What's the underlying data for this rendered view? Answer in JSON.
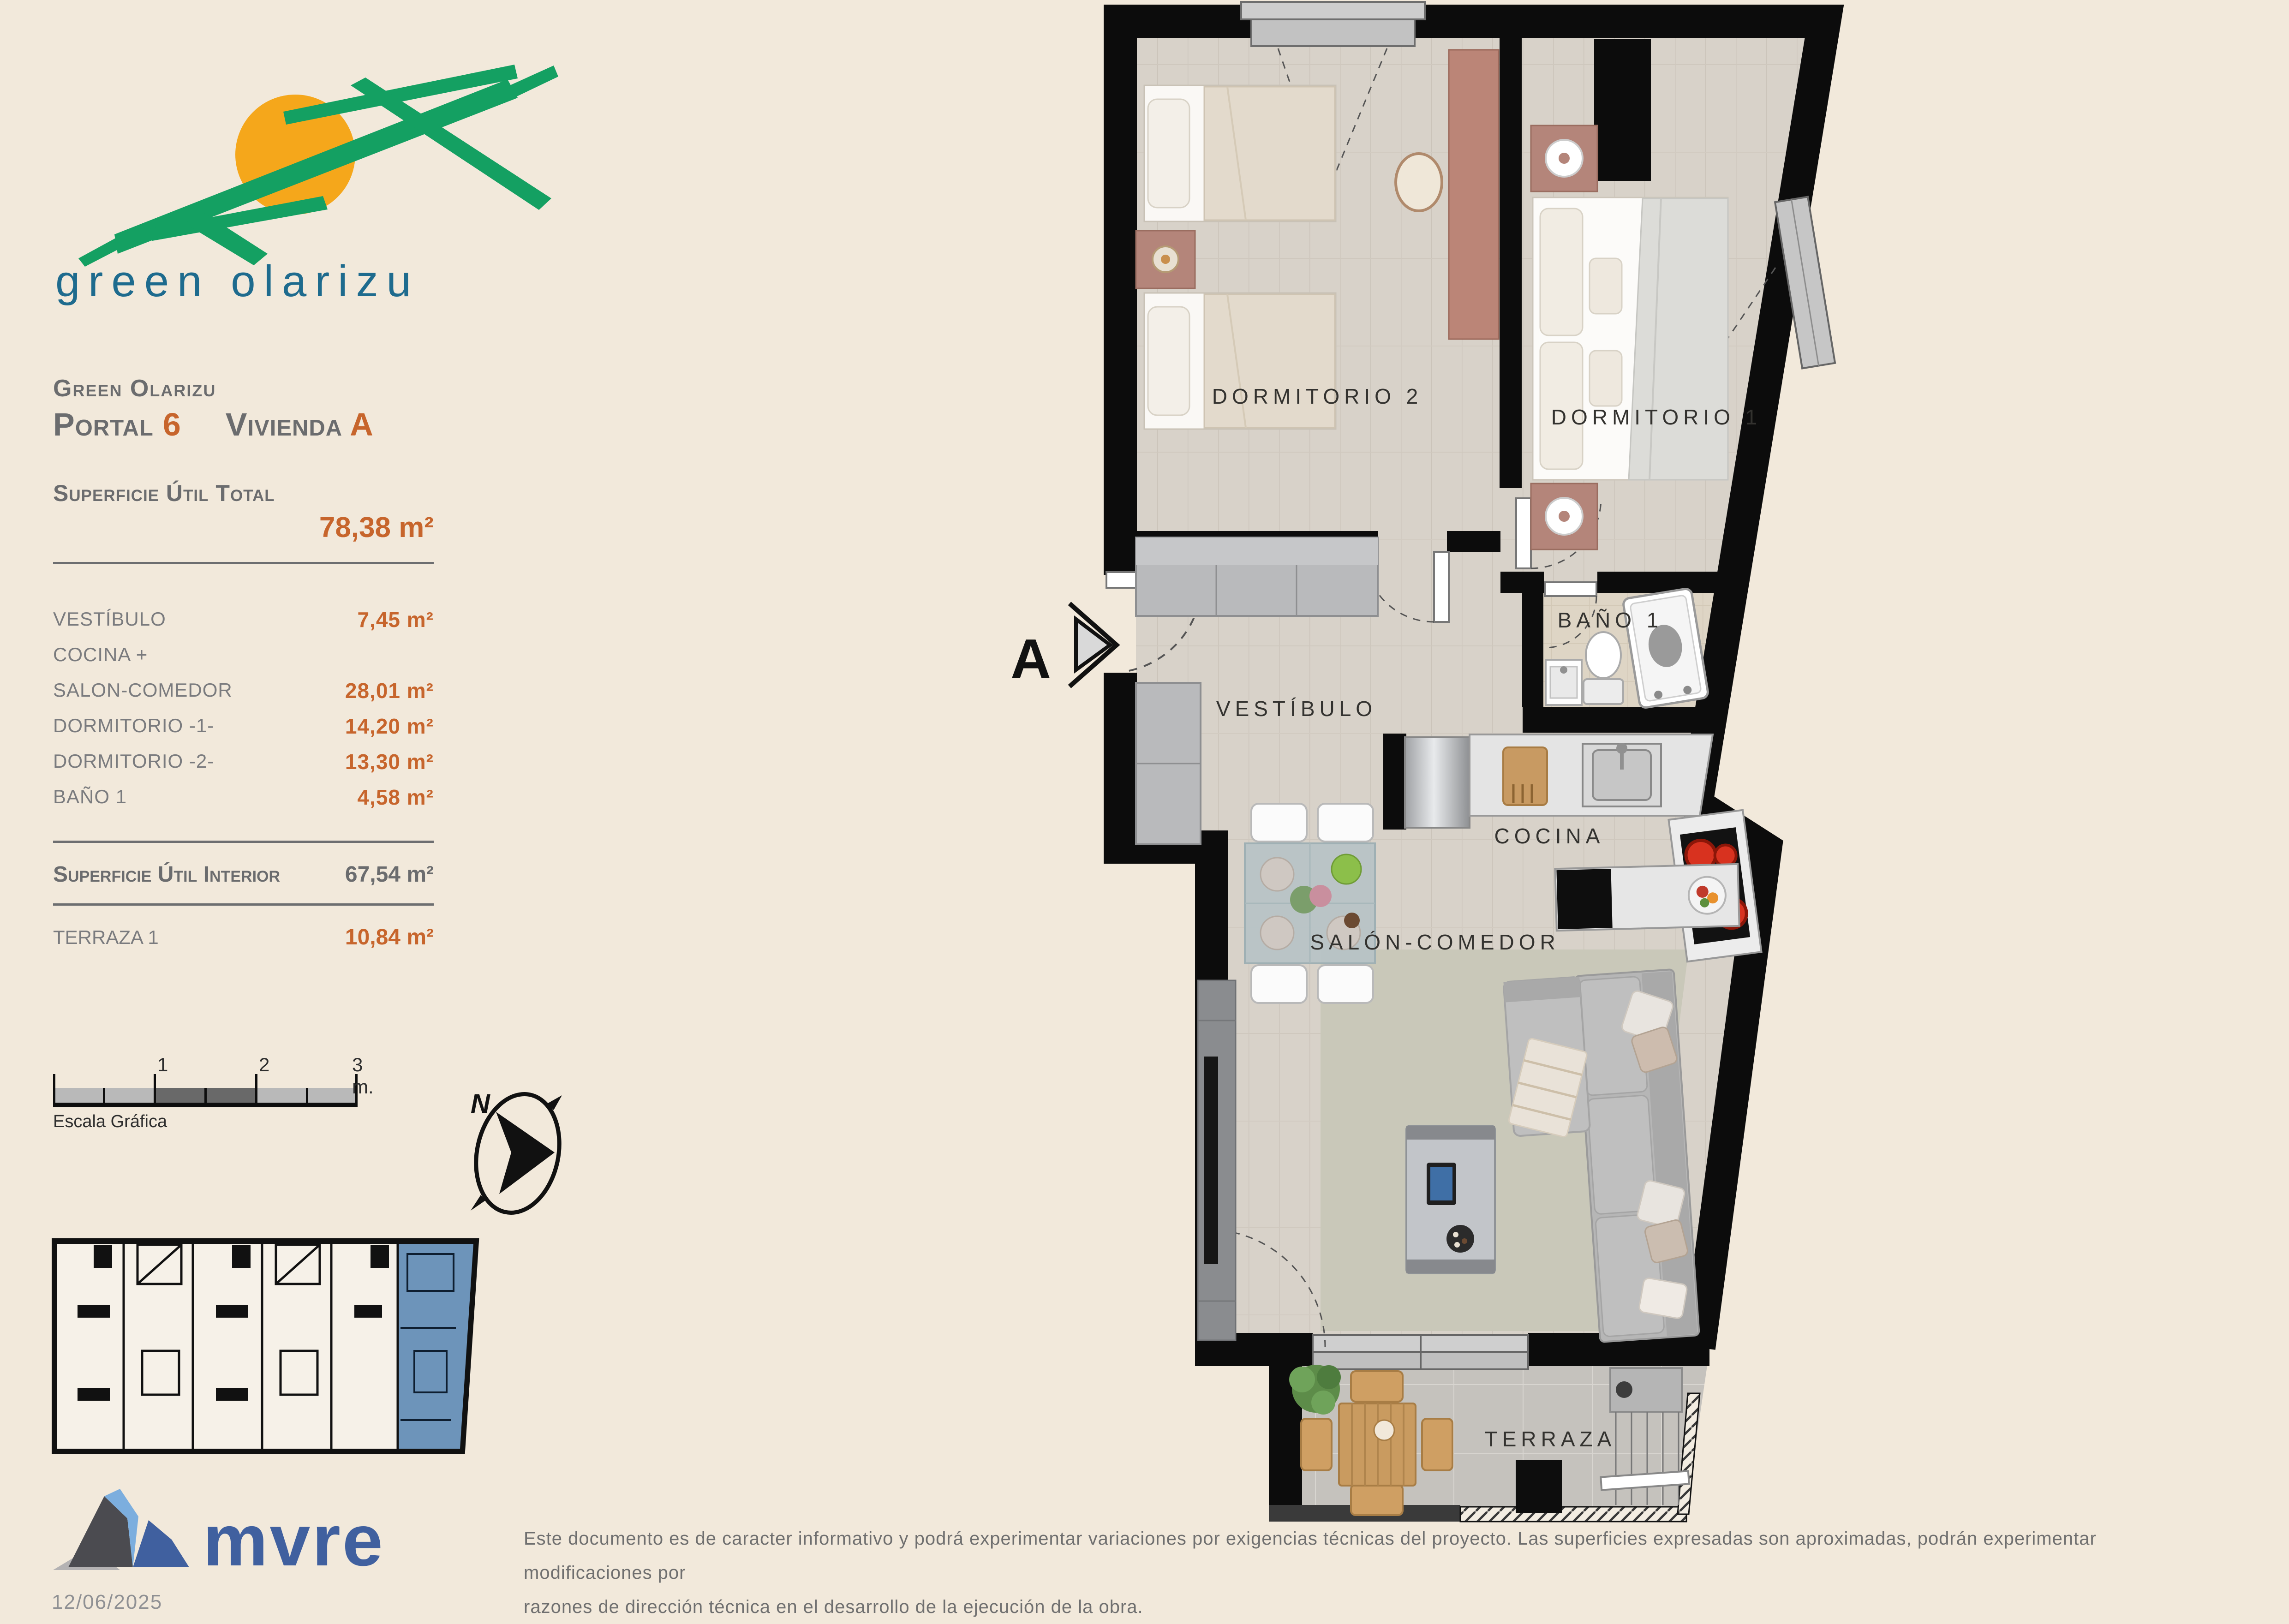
{
  "logo": {
    "text": "green olarizu"
  },
  "header": {
    "project": "Green Olarizu",
    "portal_label": "Portal",
    "portal_number": "6",
    "vivienda_label": "Vivienda",
    "vivienda_letter": "A"
  },
  "surface_total": {
    "label": "Superficie Útil Total",
    "value": "78,38 m²"
  },
  "surface_rows": [
    {
      "label": "VESTÍBULO",
      "value": "7,45 m²"
    },
    {
      "label": "COCINA +",
      "value": ""
    },
    {
      "label": "SALON-COMEDOR",
      "value": "28,01 m²"
    },
    {
      "label": "DORMITORIO -1-",
      "value": "14,20 m²"
    },
    {
      "label": "DORMITORIO -2-",
      "value": "13,30 m²"
    },
    {
      "label": "BAÑO 1",
      "value": "4,58 m²"
    }
  ],
  "surface_interior": {
    "label": "Superficie Útil Interior",
    "value": "67,54 m²"
  },
  "terraza_row": {
    "label": "TERRAZA 1",
    "value": "10,84 m²"
  },
  "scale_bar": {
    "labels": [
      "1",
      "2",
      "3 m."
    ],
    "caption": "Escala Gráfica"
  },
  "compass": {
    "north": "N"
  },
  "plan": {
    "section_marker": "A",
    "rooms": [
      {
        "label": "DORMITORIO 2"
      },
      {
        "label": "DORMITORIO 1"
      },
      {
        "label": "BAÑO 1"
      },
      {
        "label": "VESTÍBULO"
      },
      {
        "label": "COCINA"
      },
      {
        "label": "SALÓN-COMEDOR"
      },
      {
        "label": "TERRAZA"
      }
    ]
  },
  "footer": {
    "brand": "mvre",
    "date": "12/06/2025",
    "disclaimer": [
      "Este documento es de caracter informativo y podrá experimentar variaciones por exigencias técnicas del proyecto. Las superficies expresadas son aproximadas, podrán experimentar modificaciones por",
      "razones de dirección técnica en el desarrollo de la ejecución de la obra."
    ]
  },
  "colors": {
    "background": "#f2e9db",
    "accent_orange": "#c7652c",
    "text_gray": "#6d6e71",
    "logo_teal": "#1e6b8e",
    "brand_navy": "#40609f",
    "unit_highlight": "#6d94ba"
  }
}
